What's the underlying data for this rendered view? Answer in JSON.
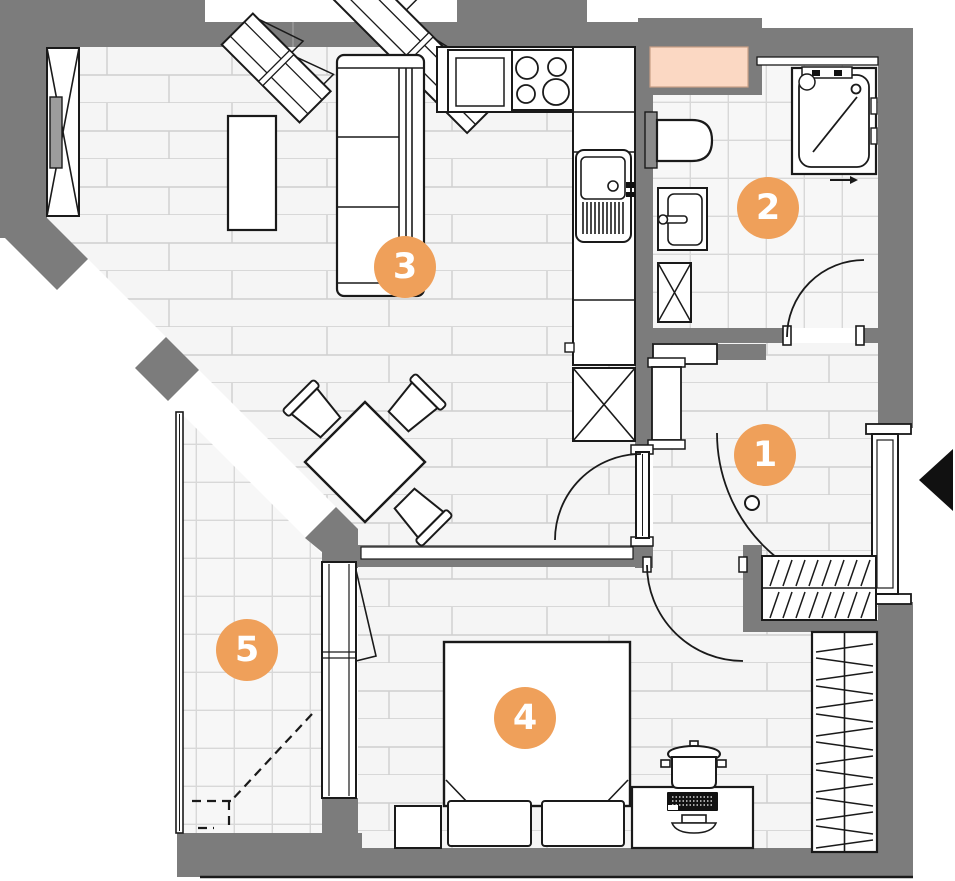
{
  "plan": {
    "markers": [
      {
        "number": "1"
      },
      {
        "number": "2"
      },
      {
        "number": "3"
      },
      {
        "number": "4"
      },
      {
        "number": "5"
      }
    ],
    "colors": {
      "marker_fill": "#EFA05A",
      "marker_text": "#FFFFFF",
      "wall": "#7C7C7C",
      "vent_shaft": "#FBD8C3",
      "wood_floor": "#F5F5F5",
      "tile_floor": "#F7F7F7",
      "outline": "#1A1A1A",
      "background": "#FFFFFF"
    }
  }
}
